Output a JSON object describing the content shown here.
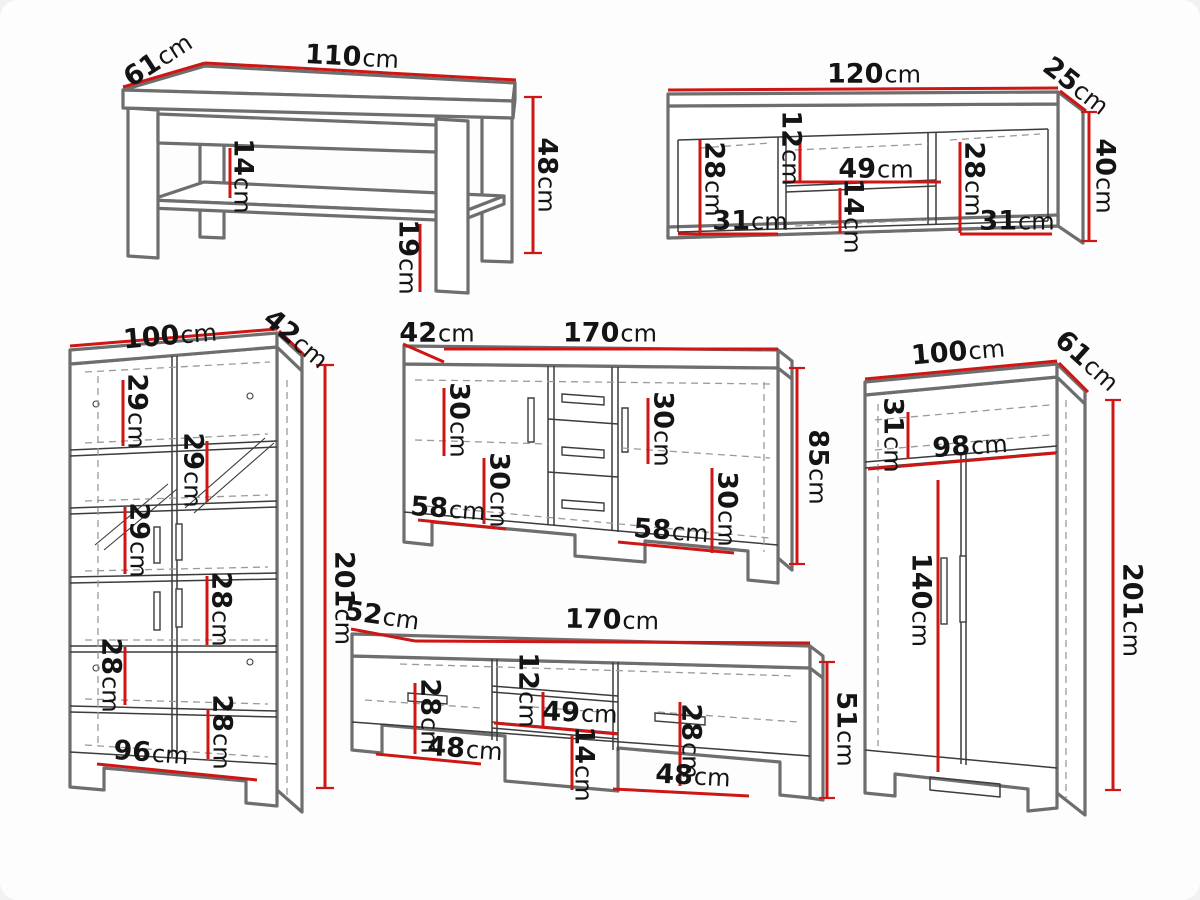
{
  "unit": "cm",
  "colors": {
    "dimension_line": "#ce1615",
    "label_text": "#141414",
    "outline": "#6e6e6e",
    "detail_line": "#3c3c3c",
    "dashed_line": "#9a9a9a",
    "background": "#fdfdfd",
    "page_background": "#f2f2f2"
  },
  "furniture": {
    "coffee_table": {
      "dims": {
        "depth": {
          "v": "61",
          "u": "cm"
        },
        "width": {
          "v": "110",
          "u": "cm"
        },
        "height": {
          "v": "48",
          "u": "cm"
        },
        "shelf_gap": {
          "v": "14",
          "u": "cm"
        },
        "leg_height": {
          "v": "19",
          "u": "cm"
        }
      }
    },
    "wall_shelf": {
      "dims": {
        "width": {
          "v": "120",
          "u": "cm"
        },
        "depth": {
          "v": "25",
          "u": "cm"
        },
        "height": {
          "v": "40",
          "u": "cm"
        },
        "left_opening_height": {
          "v": "28",
          "u": "cm"
        },
        "left_opening_width": {
          "v": "31",
          "u": "cm"
        },
        "niche_top_gap": {
          "v": "12",
          "u": "cm"
        },
        "niche_width": {
          "v": "49",
          "u": "cm"
        },
        "niche_bottom_gap": {
          "v": "14",
          "u": "cm"
        },
        "right_opening_height": {
          "v": "28",
          "u": "cm"
        },
        "right_opening_width": {
          "v": "31",
          "u": "cm"
        }
      }
    },
    "display_cabinet": {
      "dims": {
        "width": {
          "v": "100",
          "u": "cm"
        },
        "depth": {
          "v": "42",
          "u": "cm"
        },
        "height": {
          "v": "201",
          "u": "cm"
        },
        "shelf_gap_1": {
          "v": "29",
          "u": "cm"
        },
        "shelf_gap_2": {
          "v": "29",
          "u": "cm"
        },
        "shelf_gap_3": {
          "v": "29",
          "u": "cm"
        },
        "shelf_gap_4": {
          "v": "28",
          "u": "cm"
        },
        "shelf_gap_5": {
          "v": "28",
          "u": "cm"
        },
        "shelf_gap_6": {
          "v": "28",
          "u": "cm"
        },
        "inner_width": {
          "v": "96",
          "u": "cm"
        }
      }
    },
    "sideboard": {
      "dims": {
        "depth": {
          "v": "42",
          "u": "cm"
        },
        "width": {
          "v": "170",
          "u": "cm"
        },
        "height": {
          "v": "85",
          "u": "cm"
        },
        "left_top_gap": {
          "v": "30",
          "u": "cm"
        },
        "left_bottom_gap": {
          "v": "30",
          "u": "cm"
        },
        "left_inner_width": {
          "v": "58",
          "u": "cm"
        },
        "right_top_gap": {
          "v": "30",
          "u": "cm"
        },
        "right_bottom_gap": {
          "v": "30",
          "u": "cm"
        },
        "right_inner_width": {
          "v": "58",
          "u": "cm"
        }
      }
    },
    "wardrobe": {
      "dims": {
        "width": {
          "v": "100",
          "u": "cm"
        },
        "depth": {
          "v": "61",
          "u": "cm"
        },
        "height": {
          "v": "201",
          "u": "cm"
        },
        "top_shelf_gap": {
          "v": "31",
          "u": "cm"
        },
        "inner_width": {
          "v": "98",
          "u": "cm"
        },
        "hanging_height": {
          "v": "140",
          "u": "cm"
        }
      }
    },
    "tv_stand": {
      "dims": {
        "depth": {
          "v": "52",
          "u": "cm"
        },
        "width": {
          "v": "170",
          "u": "cm"
        },
        "height": {
          "v": "51",
          "u": "cm"
        },
        "left_opening_height": {
          "v": "28",
          "u": "cm"
        },
        "left_opening_width": {
          "v": "48",
          "u": "cm"
        },
        "niche_top_gap": {
          "v": "12",
          "u": "cm"
        },
        "niche_width": {
          "v": "49",
          "u": "cm"
        },
        "niche_bottom_gap": {
          "v": "14",
          "u": "cm"
        },
        "right_opening_height": {
          "v": "28",
          "u": "cm"
        },
        "right_opening_width": {
          "v": "48",
          "u": "cm"
        }
      }
    }
  }
}
